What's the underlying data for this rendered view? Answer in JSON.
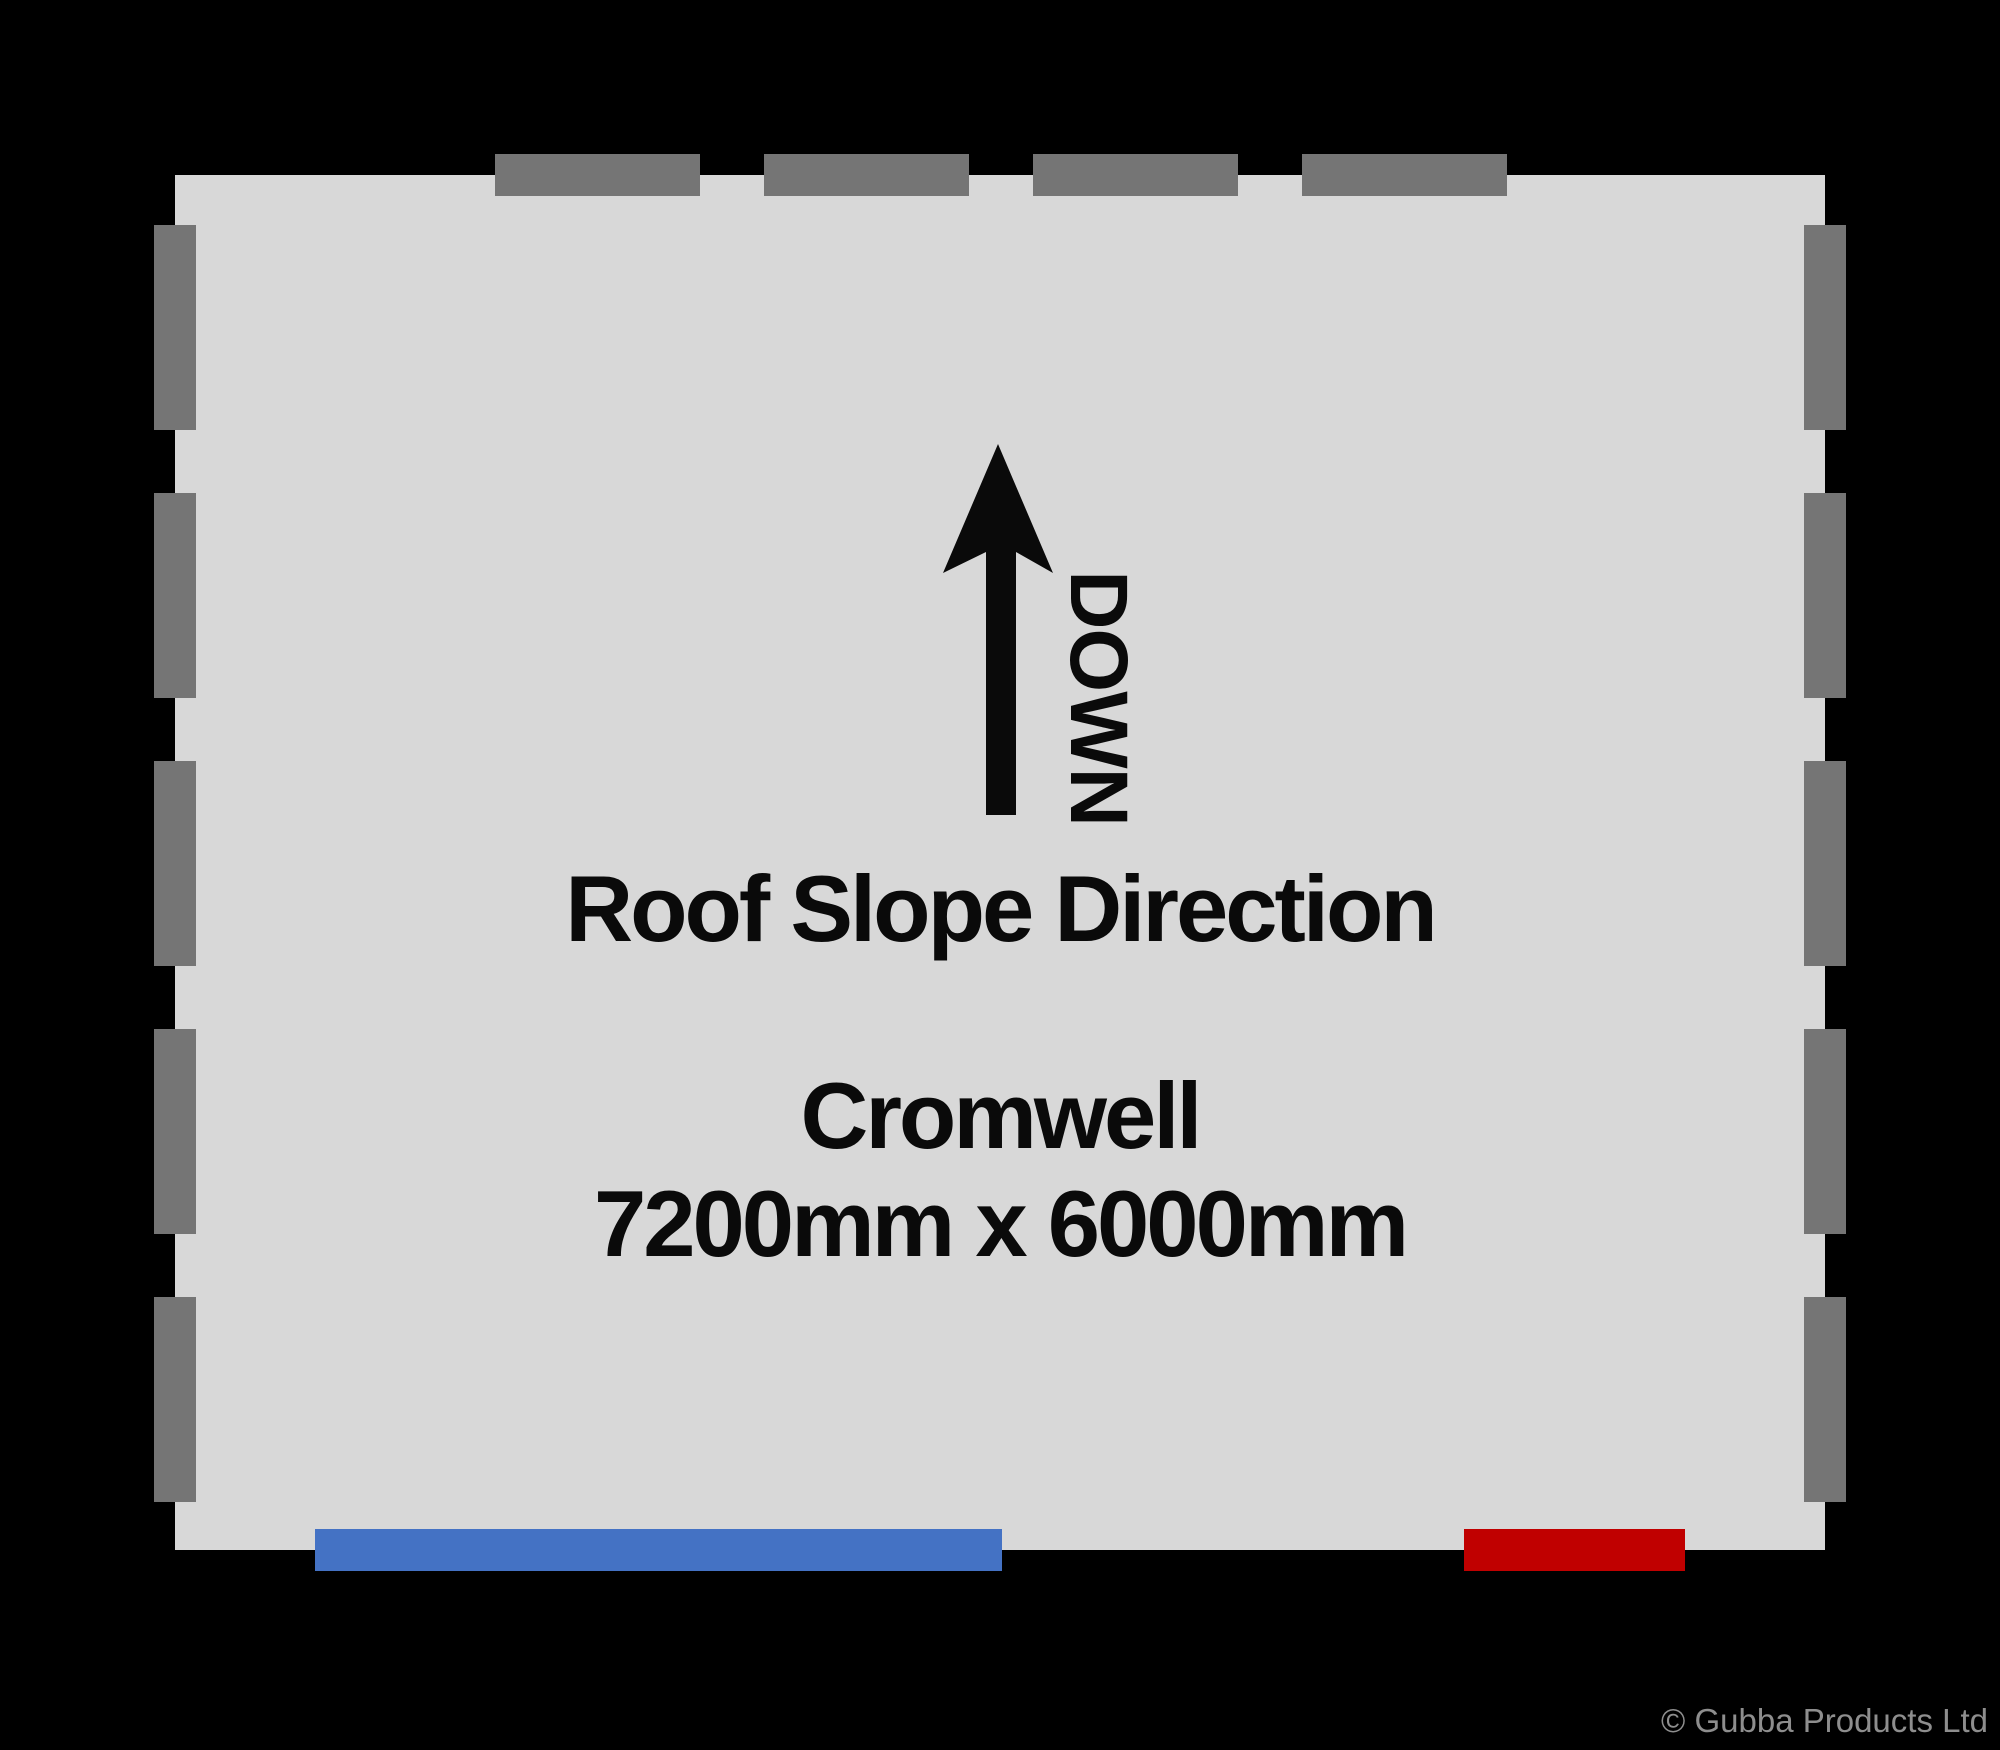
{
  "plan": {
    "name": "Cromwell",
    "size": "7200mm x 6000mm",
    "roof_slope_label": "Roof Slope Direction",
    "arrow_label": "DOWN"
  },
  "legend": {
    "door_marker": "door",
    "window_marker": "window",
    "wall_marker": "dashed wall segment"
  },
  "footer": {
    "copyright": "© Gubba Products Ltd"
  },
  "colors": {
    "background": "#000000",
    "floor": "#D8D8D8",
    "wall_dash": "#757575",
    "door": "#4472C4",
    "window": "#C00000",
    "ink": "#0A0A0A",
    "copyright": "#8E8E8E"
  }
}
